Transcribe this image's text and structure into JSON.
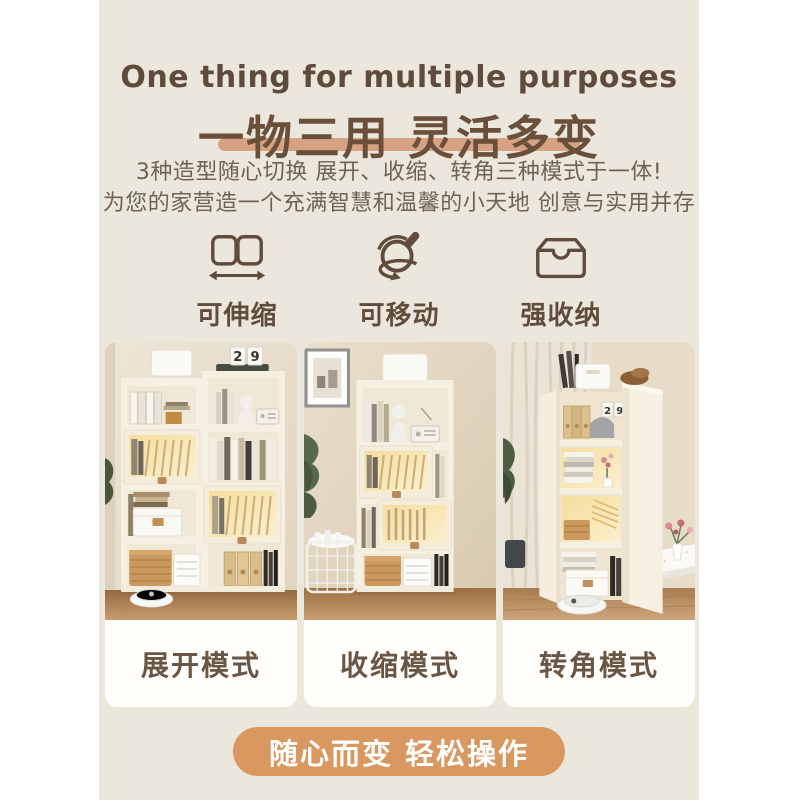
{
  "colors": {
    "page_bg": "#ffffff",
    "panel_bg": "#ece7dc",
    "title_en_color": "#5e4b3c",
    "title_cn_color": "#6a4f3a",
    "underline_color": "#d6a283",
    "body_text_color": "#6f6255",
    "icon_color": "#5f4c3c",
    "mode_label_color": "#6a5644",
    "pill_bg": "#d8985f",
    "pill_text_color": "#ffffff"
  },
  "header": {
    "title_en": "One thing for multiple purposes",
    "title_cn": "一物三用 灵活多变",
    "subtitle_line1": "3种造型随心切换 展开、收缩、转角三种模式于一体!",
    "subtitle_line2": "为您的家营造一个充满智慧和温馨的小天地 创意与实用并存"
  },
  "features": [
    {
      "icon": "stretch-arrows-icon",
      "label": "可伸缩"
    },
    {
      "icon": "caster-wheel-icon",
      "label": "可移动"
    },
    {
      "icon": "storage-box-icon",
      "label": "强收纳"
    }
  ],
  "modes": [
    {
      "label": "展开模式",
      "photo": "expanded-bookshelf-scene"
    },
    {
      "label": "收缩模式",
      "photo": "contracted-bookshelf-scene"
    },
    {
      "label": "转角模式",
      "photo": "corner-bookshelf-scene"
    }
  ],
  "photo_text": {
    "calendar_digit_left": "2",
    "calendar_digit_right": "9"
  },
  "footer": {
    "pill_label": "随心而变 轻松操作"
  }
}
